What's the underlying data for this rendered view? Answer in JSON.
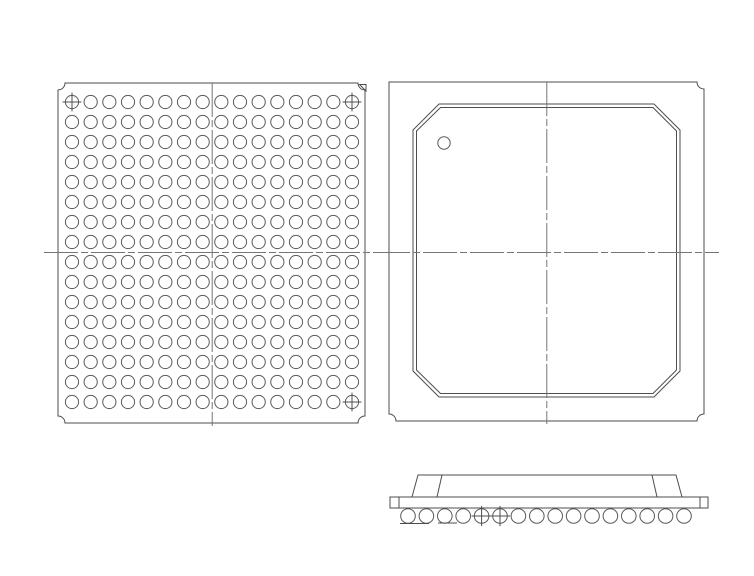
{
  "page": {
    "background_color": "#ffffff",
    "description": "Mechanical outline drawing of a BGA chip package: bottom view with solder-ball grid, top view with chamfered lid and pin-1 dot, and side profile view with ball row"
  },
  "drawing": {
    "colors": {
      "line": "#4d4d4d",
      "ball_stroke": "#5a5a5a",
      "centerline": "#757575"
    },
    "bottom_view": {
      "name": "bottom view (ball grid array)",
      "grid": {
        "columns": 16,
        "rows": 16,
        "total_balls": 256
      },
      "fiducial_cells": [
        [
          1,
          1
        ],
        [
          16,
          1
        ],
        [
          16,
          16
        ]
      ],
      "fiducial_style": "crosshair ball",
      "pin1_marker": "small triangle, top-right corner",
      "corner_style": "concave notch, all four corners",
      "centerlines": "horizontal and vertical dashed centerlines"
    },
    "top_view": {
      "name": "top view",
      "lid": "square lid with chamfered corners, double outline",
      "pin1_marker": "small circle dot near top-left lid corner",
      "corner_style": "concave notch on top-right, bottom-right, bottom-left; sharp top-left",
      "centerlines": "horizontal and vertical dashed centerlines"
    },
    "side_view": {
      "name": "side profile view",
      "ball_count": 16,
      "crosshair_balls": [
        5,
        6
      ],
      "features": [
        "beveled lid",
        "substrate plate with end tabs",
        "seating-plane tick lines under left balls"
      ]
    }
  }
}
